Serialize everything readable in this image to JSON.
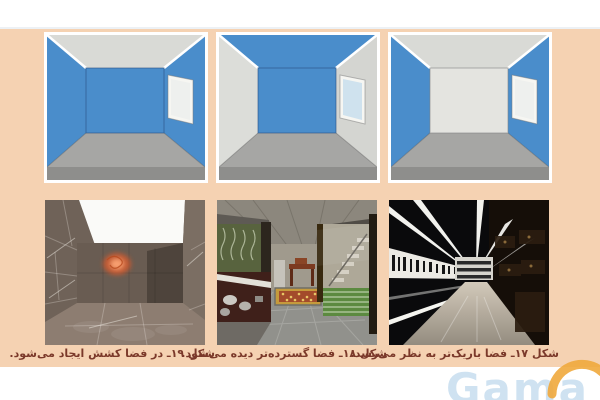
{
  "document": {
    "type": "textbook-figure-panel",
    "language": "fa",
    "direction": "rtl"
  },
  "palette": {
    "page_background": "#ffffff",
    "panel_background": "#f5d2b2",
    "wall_blue": "#4a8dcb",
    "ceiling_light_gray": "#d9dad6",
    "back_wall_light": "#e4e4e0",
    "side_wall_light": "#dcddd9",
    "floor_gray": "#a6a6a4",
    "floor_edge_gray": "#8e8e8c",
    "frame_white": "#ffffff",
    "caption_color": "#7b392a"
  },
  "figures": [
    {
      "number": "۱۷",
      "column": "right",
      "caption": "شکل ۱۷ـ فضا باریک‌تر به نظر می‌رسد.",
      "diagram": {
        "ceiling": "light-gray",
        "back_wall": "light-gray",
        "left_wall": "blue",
        "right_wall": "blue",
        "window": "right-wall"
      },
      "photo_subject": "dark narrow corridor with white linear lights"
    },
    {
      "number": "۱۸",
      "column": "middle",
      "caption": "شکل ۱۸ـ فضا گسترده‌تر دیده می‌شود.",
      "diagram": {
        "ceiling": "blue",
        "back_wall": "blue",
        "left_wall": "light-gray",
        "right_wall": "light-gray",
        "window": "right-wall"
      },
      "photo_subject": "open interior with concrete ceiling, rug and garden view"
    },
    {
      "number": "۱۹",
      "column": "left",
      "caption": "شکل ۱۹ـ در فضا کشش ایجاد می‌شود.",
      "diagram": {
        "ceiling": "light-gray",
        "back_wall": "blue",
        "left_wall": "blue",
        "right_wall": "blue",
        "window": "right-wall"
      },
      "photo_subject": "stone-tiled room with bright skylight and orange neon sign"
    }
  ],
  "watermark": {
    "text": "Gama",
    "text_color": "#a8cae6",
    "arc_color": "#f0a83c"
  }
}
